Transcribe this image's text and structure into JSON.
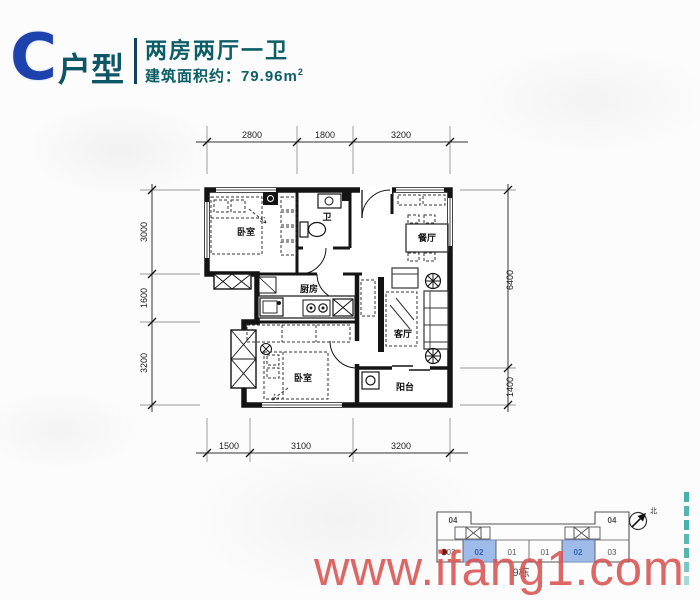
{
  "header": {
    "unit_letter": "C",
    "unit_suffix": "户型",
    "title": "两房两厅一卫",
    "area_label": "建筑面积约：79.96m",
    "area_sup": "2",
    "accent_blue": "#1d41ad",
    "accent_teal": "#0b5d66"
  },
  "floorplan": {
    "rooms": {
      "bedroom1": "卧室",
      "bath": "卫",
      "dining": "餐厅",
      "kitchen": "厨房",
      "living": "客厅",
      "bedroom2": "卧室",
      "balcony": "阳台"
    },
    "dims": {
      "top": [
        "2800",
        "1800",
        "3200"
      ],
      "left": [
        "3000",
        "1600",
        "3200"
      ],
      "right": [
        "6400",
        "1400"
      ],
      "bottom": [
        "1500",
        "3100",
        "3200"
      ]
    }
  },
  "keyplan": {
    "top_units": [
      "04",
      "04"
    ],
    "bottom_units": [
      "03",
      "02",
      "01",
      "01",
      "02",
      "03"
    ],
    "building_label": "9栋",
    "compass_label": "北",
    "highlight_color": "#9fbbe9"
  },
  "watermark": {
    "text": "www.ifang1.com",
    "color": "#d85350"
  }
}
